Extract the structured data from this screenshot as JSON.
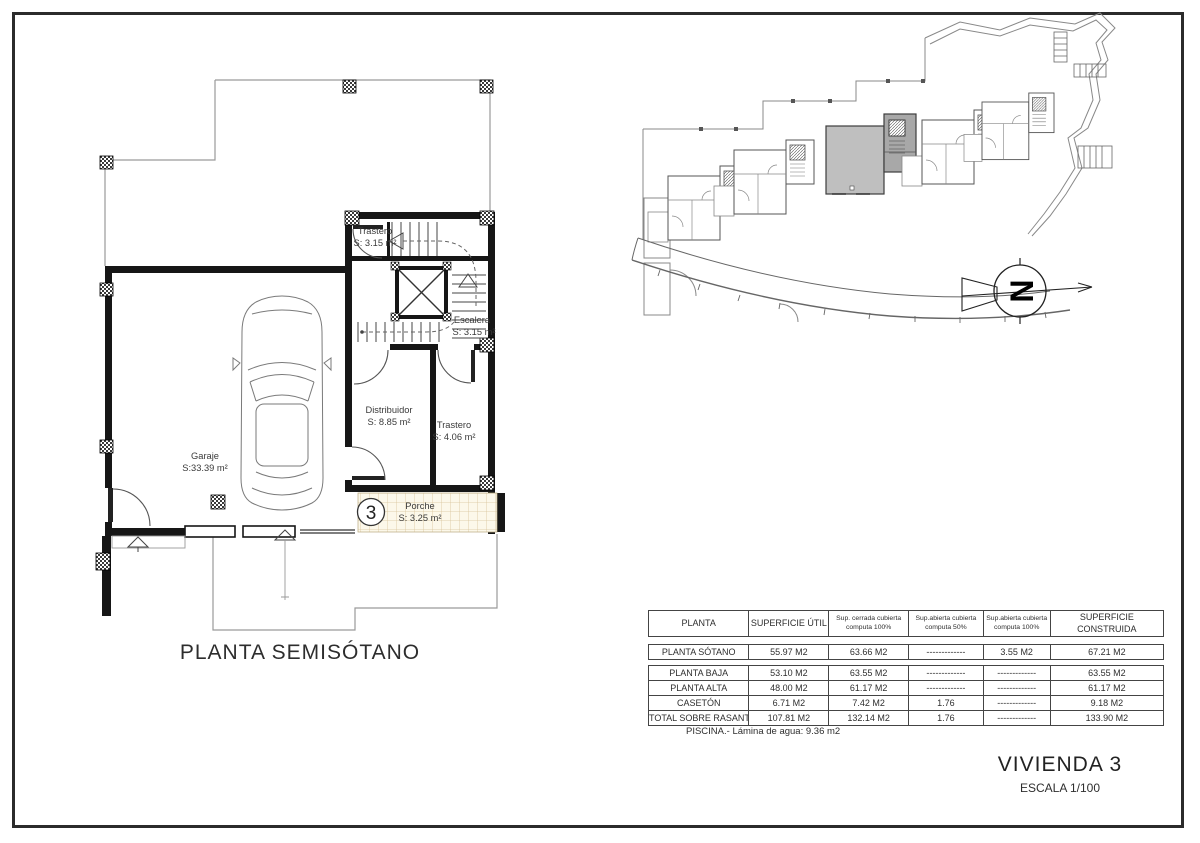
{
  "sheet": {
    "floor_title": "PLANTA SEMISÓTANO",
    "project_title": "VIVIENDA 3",
    "scale_label": "ESCALA 1/100",
    "pool_note": "PISCINA.- Lámina de agua: 9.36 m2",
    "unit_badge": "3",
    "compass_letter": "N"
  },
  "plan": {
    "rooms": {
      "trastero_top": {
        "name": "Trastero",
        "area": "S: 3.15 m²"
      },
      "escalera": {
        "name": "Escalera",
        "area": "S: 3.15 m²"
      },
      "distribuidor": {
        "name": "Distribuidor",
        "area": "S: 8.85 m²"
      },
      "trastero_low": {
        "name": "Trastero",
        "area": "S: 4.06 m²"
      },
      "garaje": {
        "name": "Garaje",
        "area": "S:33.39 m²"
      },
      "porche": {
        "name": "Porche",
        "area": "S: 3.25 m²"
      }
    }
  },
  "areas_table": {
    "headers": [
      "PLANTA",
      "SUPERFICIE ÚTIL",
      "Sup. cerrada cubierta\ncomputa 100%",
      "Sup.abierta cubierta\ncomputa 50%",
      "Sup.abierta cubierta\ncomputa 100%",
      "SUPERFICIE CONSTRUIDA"
    ],
    "rows": [
      [
        "PLANTA SÓTANO",
        "55.97 M2",
        "63.66 M2",
        "-------------",
        "3.55 M2",
        "67.21 M2"
      ],
      [
        "PLANTA BAJA",
        "53.10 M2",
        "63.55 M2",
        "-------------",
        "-------------",
        "63.55 M2"
      ],
      [
        "PLANTA ALTA",
        "48.00 M2",
        "61.17 M2",
        "-------------",
        "-------------",
        "61.17 M2"
      ],
      [
        "CASETÓN",
        "6.71 M2",
        "7.42 M2",
        "1.76",
        "-------------",
        "9.18 M2"
      ],
      [
        "TOTAL SOBRE RASANTE",
        "107.81 M2",
        "132.14 M2",
        "1.76",
        "-------------",
        "133.90 M2"
      ]
    ]
  },
  "colors": {
    "highlighted_unit": "#bfbfbf",
    "porch_tile_line": "#d8c49a",
    "wall": "#161616"
  }
}
